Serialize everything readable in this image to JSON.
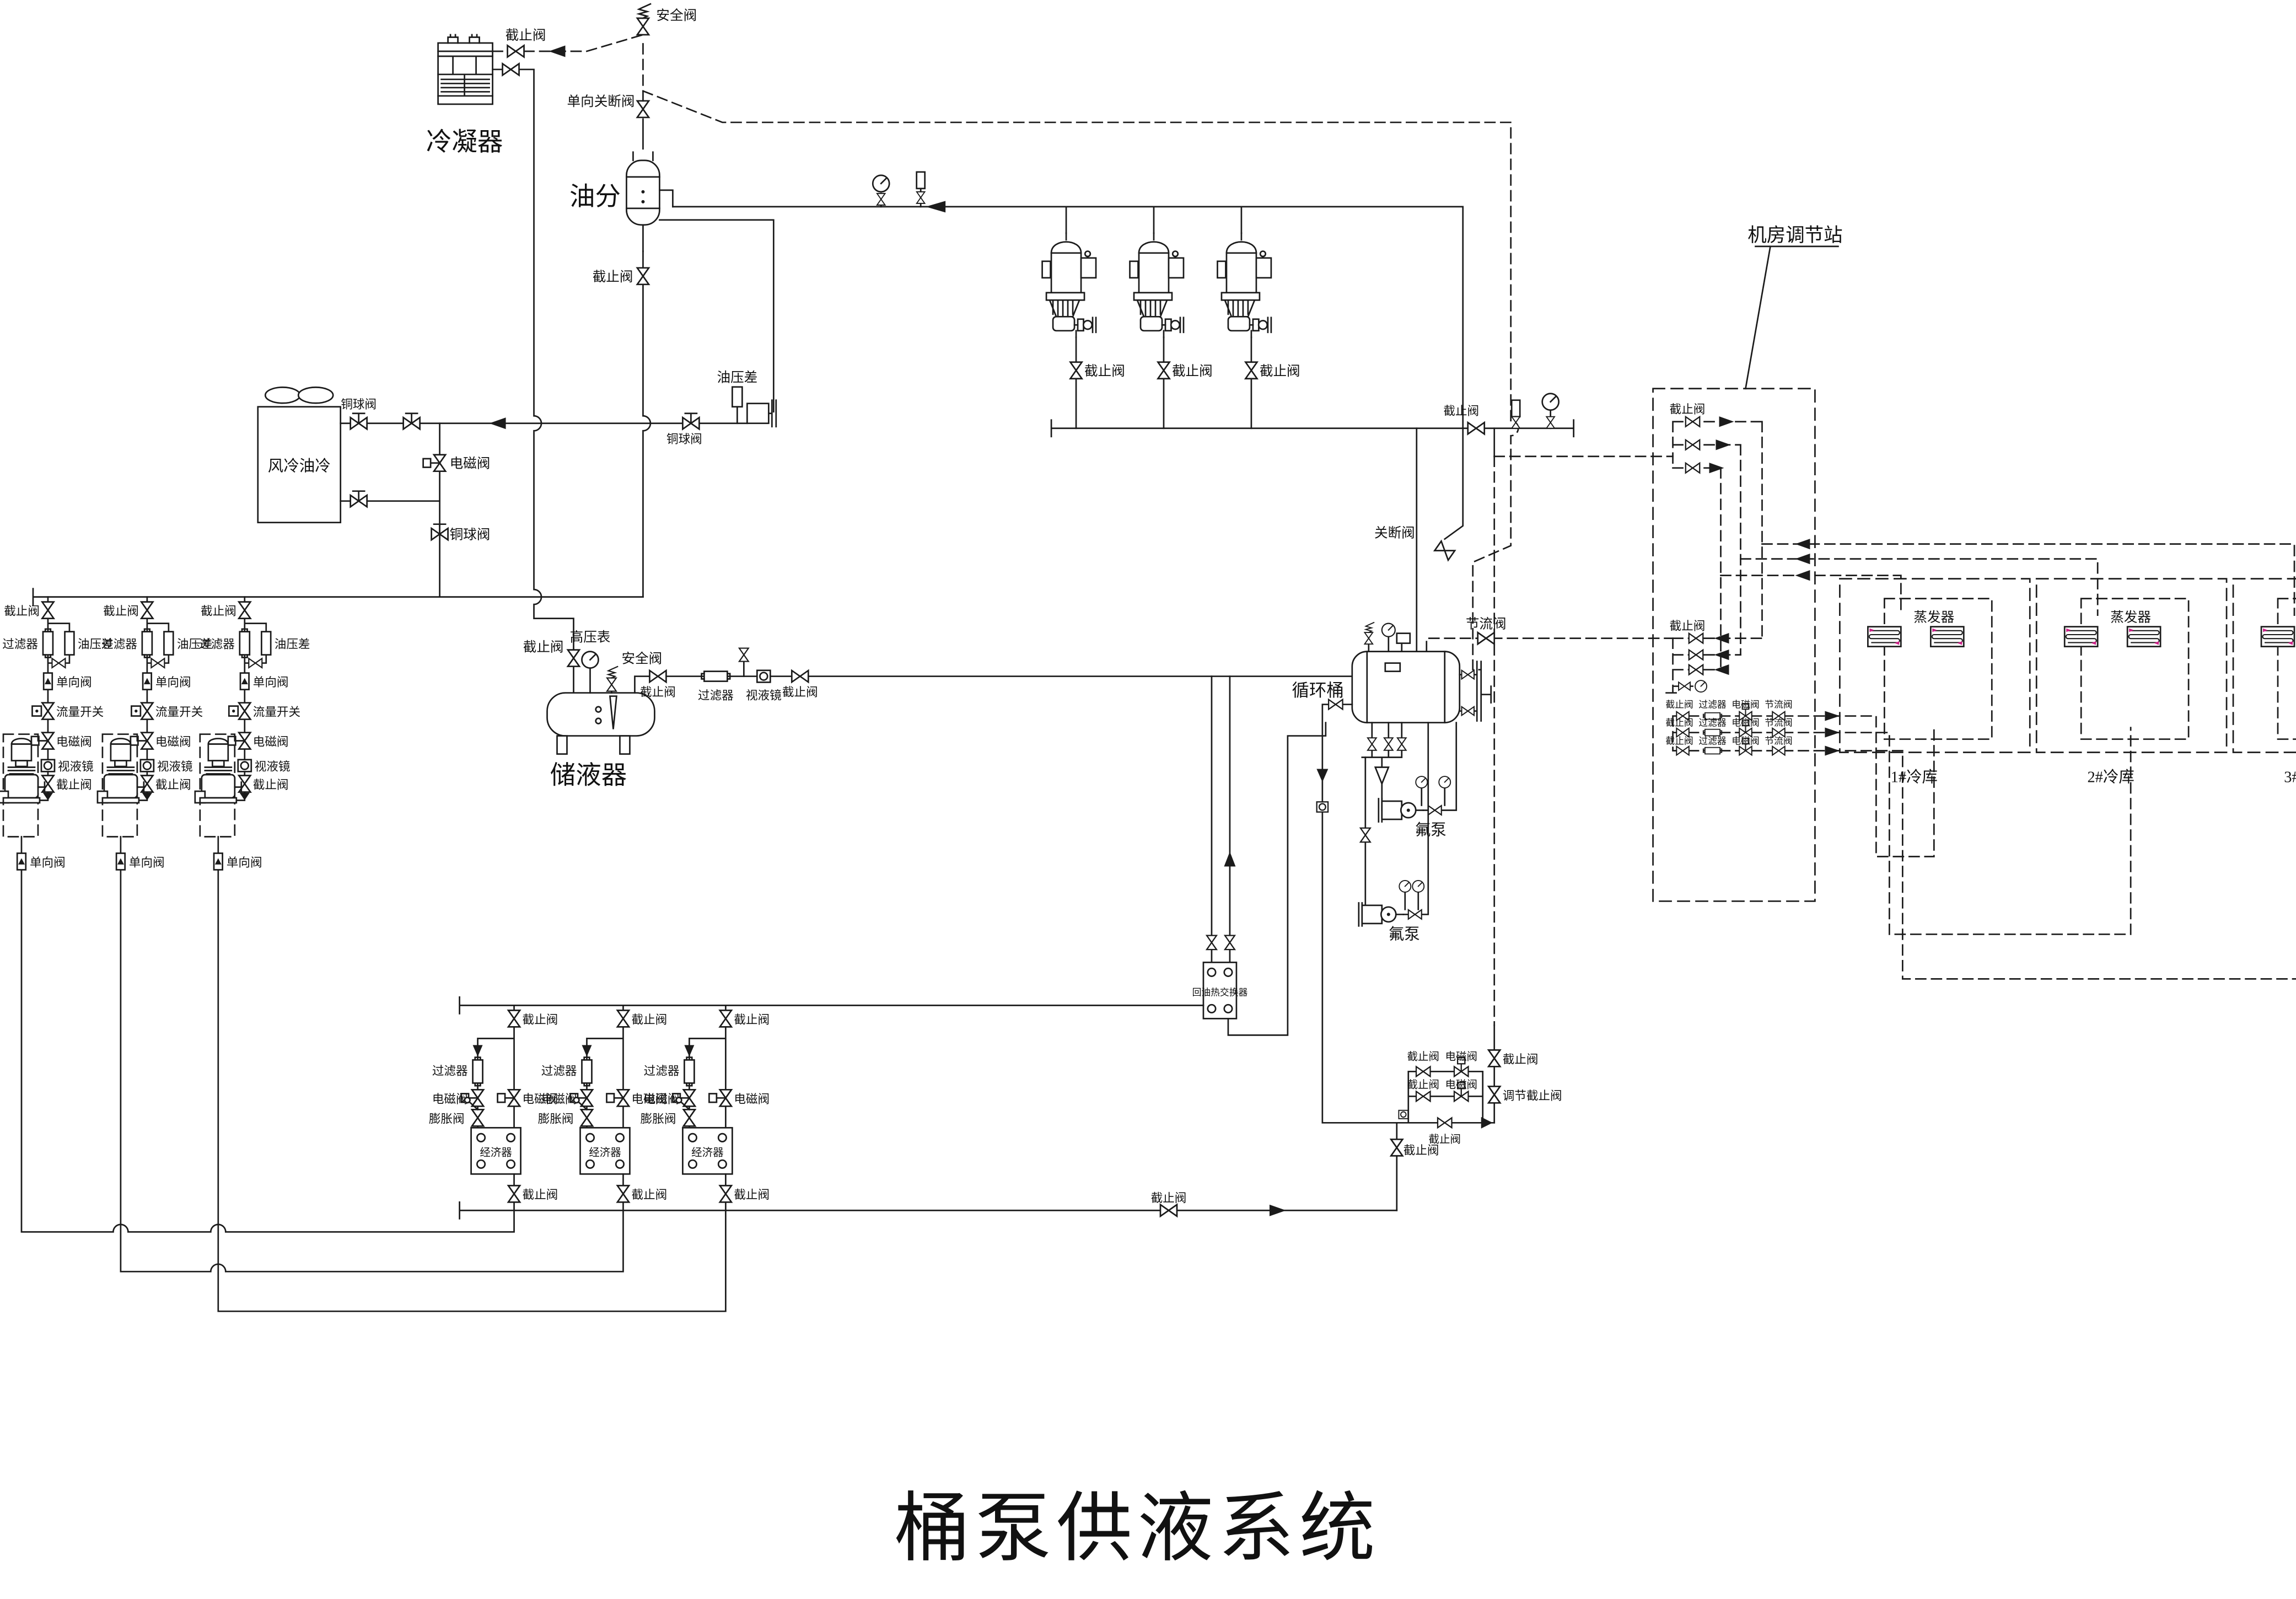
{
  "title": "桶泵供液系统",
  "colors": {
    "line": "#1b1b1b",
    "coil_fill": "#b8dde8",
    "coil_stroke": "#1b1b1b",
    "accent": "#cc2288"
  },
  "equipment": {
    "condenser": "冷凝器",
    "oil_separator": "油分",
    "air_cooled_oil_cooler": "风冷油冷",
    "receiver": "储液器",
    "circulation_barrel": "循环桶",
    "fluorine_pump": "氟泵",
    "oil_return_heat_exchanger": "回油热交换器",
    "economizer": "经济器",
    "evaporator": "蒸发器",
    "machine_room_station": "机房调节站",
    "cold_rooms": [
      {
        "label": "1#冷库"
      },
      {
        "label": "2#冷库"
      },
      {
        "label": "3#冷库"
      }
    ]
  },
  "valves": {
    "stop": "截止阀",
    "solenoid": "电磁阀",
    "check": "单向阀",
    "one_way_shutoff": "单向关断阀",
    "shutoff": "关断阀",
    "copper_ball": "铜球阀",
    "safety": "安全阀",
    "throttle": "节流阀",
    "regulating_stop": "调节截止阀",
    "expansion": "膨胀阀"
  },
  "instruments": {
    "filter": "过滤器",
    "oil_pressure_diff": "油压差",
    "flow_switch": "流量开关",
    "sight_glass": "视液镜",
    "high_pressure_gauge": "高压表"
  }
}
